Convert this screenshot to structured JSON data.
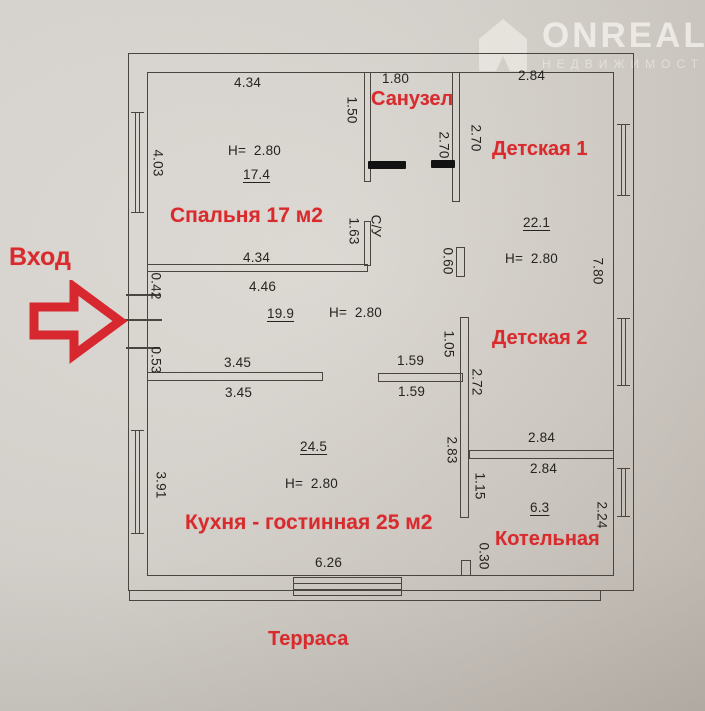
{
  "watermark": {
    "brand": "ONREALT",
    "tagline": "НЕДВИЖИМОСТЬ"
  },
  "entrance": {
    "label": "Вход"
  },
  "rooms": {
    "bathroom": "Санузел",
    "kids1": "Детская 1",
    "bedroom": "Спальня 17 м2",
    "kids2": "Детская 2",
    "kitchen": "Кухня - гостинная 25 м2",
    "boiler": "Котельная",
    "terrace": "Терраса"
  },
  "areas": {
    "bedroom": "17.4",
    "kids1": "22.1",
    "hall": "19.9",
    "kitchen": "24.5",
    "boiler": "6.3"
  },
  "heights": {
    "bedroom": "H=  2.80",
    "kids1": "H=  2.80",
    "hall": "H=  2.80",
    "kitchen": "H=  2.80"
  },
  "dims": {
    "bedroom_width_top": "4.34",
    "bathroom_width": "1.80",
    "kids1_width": "2.84",
    "bedroom_width_bottom": "4.34",
    "hall_width_top": "4.46",
    "bedroom_height_left": "4.03",
    "bathroom_wall_left": "1.50",
    "bathroom_height_a": "2.70",
    "bathroom_height_b": "2.70",
    "hall_stub_height": "1.63",
    "su_label": "С/У",
    "entry_offset_top": "0.42",
    "entry_offset_bottom": "0.53",
    "stub_060": "0.60",
    "kids_height_right": "7.80",
    "kids2_wall_top": "1.05",
    "kids2_wall_height": "2.72",
    "kids2_wall_left": "2.83",
    "kitchen_wall_left_a": "3.45",
    "kitchen_wall_left_b": "3.45",
    "kitchen_wall_right_a": "1.59",
    "kitchen_wall_right_b": "1.59",
    "boiler_width_a": "2.84",
    "boiler_width_b": "2.84",
    "boiler_wall_left": "1.15",
    "boiler_height_right": "2.24",
    "boiler_door_stub": "0.30",
    "kitchen_height_left": "3.91",
    "kitchen_width_bottom": "6.26"
  },
  "colors": {
    "accent_red": "#d92a2d",
    "line": "#4a453e",
    "paper": "#d6d1ca"
  }
}
